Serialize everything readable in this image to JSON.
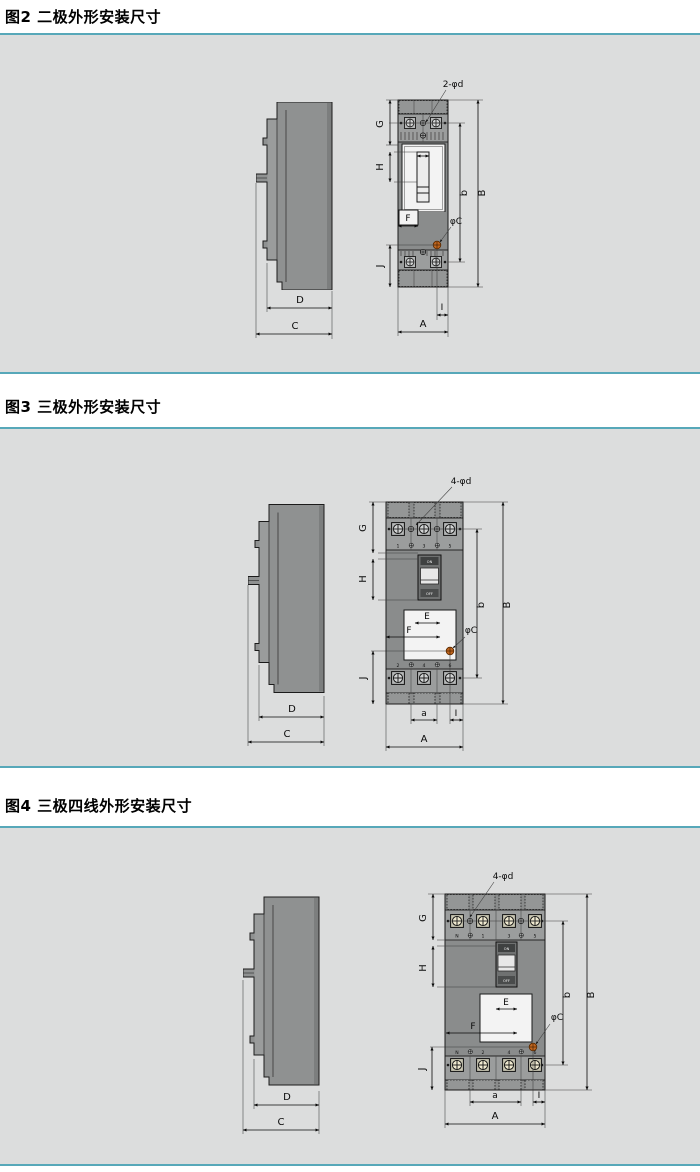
{
  "page": {
    "background": "#ffffff",
    "panel_background": "#dcdddd",
    "accent_line_color": "#57a8b9",
    "drawing_outline_color": "#1b1b1b",
    "body_gray": "#8f9191",
    "band_gray": "#9b9d9d",
    "face_white": "#f3f3f3",
    "mounting_hole_marker_color": "#c2661f"
  },
  "figures": [
    {
      "title": "图2 二极外形安装尺寸",
      "holes_label": "2-φd",
      "phi_c_label": "φC",
      "dims": {
        "A": "A",
        "B": "B",
        "b": "b",
        "C": "C",
        "D": "D",
        "F": "F",
        "G": "G",
        "H": "H",
        "I": "I",
        "J": "J"
      }
    },
    {
      "title": "图3 三极外形安装尺寸",
      "holes_label": "4-φd",
      "phi_c_label": "φC",
      "dims": {
        "A": "A",
        "B": "B",
        "b": "b",
        "C": "C",
        "D": "D",
        "E": "E",
        "F": "F",
        "G": "G",
        "H": "H",
        "I": "I",
        "J": "J",
        "a": "a"
      },
      "toggle": {
        "on": "ON",
        "off": "OFF"
      },
      "top_terminals": [
        "1",
        "3",
        "5"
      ],
      "bottom_terminals": [
        "2",
        "4",
        "6"
      ]
    },
    {
      "title": "图4 三极四线外形安装尺寸",
      "holes_label": "4-φd",
      "phi_c_label": "φC",
      "dims": {
        "A": "A",
        "B": "B",
        "b": "b",
        "C": "C",
        "D": "D",
        "E": "E",
        "F": "F",
        "G": "G",
        "H": "H",
        "I": "I",
        "J": "J",
        "a": "a"
      },
      "toggle": {
        "on": "ON",
        "off": "OFF"
      },
      "top_terminals": [
        "N",
        "1",
        "3",
        "5"
      ],
      "bottom_terminals": [
        "N",
        "2",
        "4",
        "6"
      ]
    }
  ]
}
